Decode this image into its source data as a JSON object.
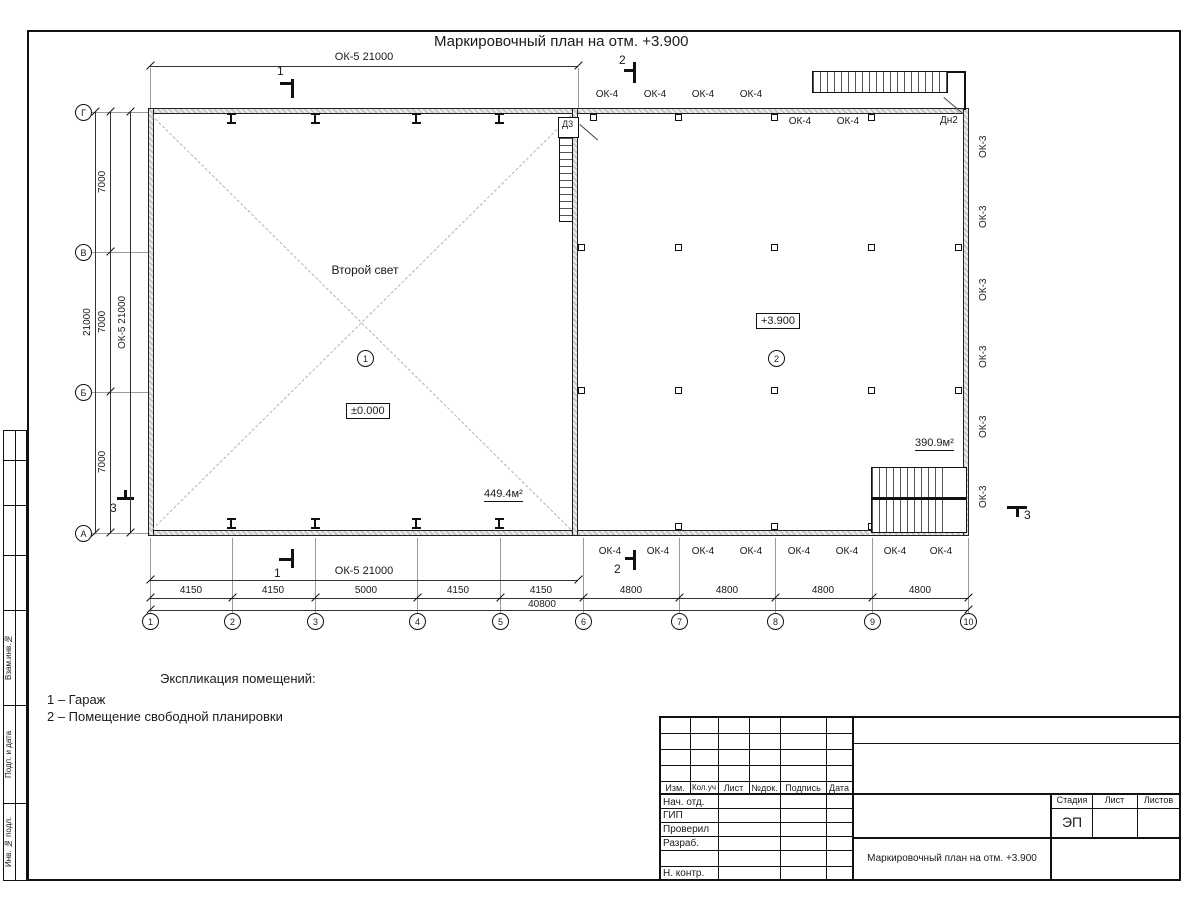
{
  "sheet_title": "Маркировочный план на отм. +3.900",
  "grid": {
    "letters": [
      "Г",
      "В",
      "Б",
      "А"
    ],
    "numbers": [
      "1",
      "2",
      "3",
      "4",
      "5",
      "6",
      "7",
      "8",
      "9",
      "10"
    ]
  },
  "dims": {
    "ok5_21000": "ОК-5 21000",
    "left_total": "21000",
    "left_spans": [
      "7000",
      "7000",
      "7000"
    ],
    "bottom_spans": [
      "4150",
      "4150",
      "5000",
      "4150",
      "4150",
      "4800",
      "4800",
      "4800",
      "4800"
    ],
    "bottom_total": "40800"
  },
  "sections": {
    "s1": "1",
    "s2": "2",
    "s3": "3"
  },
  "rooms": {
    "room1": {
      "name": "Второй свет",
      "num": "1",
      "elev": "±0.000",
      "area": "449.4м²"
    },
    "room2": {
      "num": "2",
      "elev": "+3.900",
      "area": "390.9м²"
    }
  },
  "openings": {
    "ok4": "ОК-4",
    "ok3": "ОК-3",
    "d3": "Д3",
    "dn2": "Дн2"
  },
  "legend": {
    "header": "Экспликация помещений:",
    "items": [
      "1 – Гараж",
      "2 – Помещение свободной планировки"
    ]
  },
  "stamp": {
    "cols": [
      "Изм.",
      "Кол.уч",
      "Лист",
      "№док.",
      "Подпись",
      "Дата"
    ],
    "rows": [
      "Нач. отд.",
      "ГИП",
      "Проверил",
      "Разраб.",
      "Н. контр."
    ],
    "stage_label": "Стадия",
    "sheet_label": "Лист",
    "sheets_label": "Листов",
    "stage_value": "ЭП",
    "doc_title": "Маркировочный план на отм. +3.900",
    "side": [
      "Взам.инв.№",
      "Подп. и дата",
      "Инв. № подл."
    ]
  }
}
